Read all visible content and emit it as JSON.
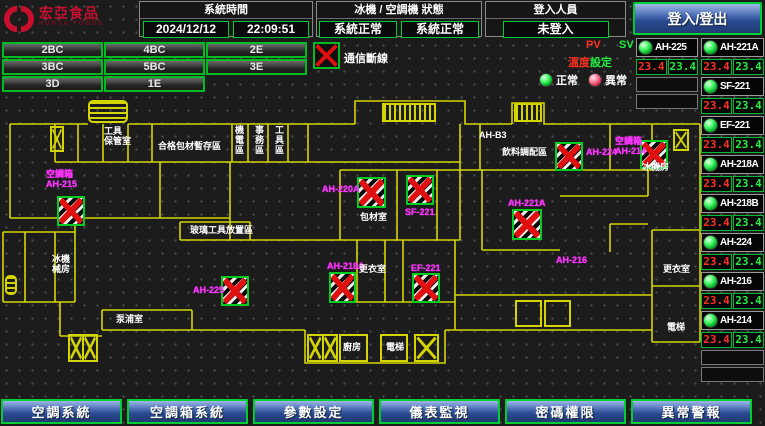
{
  "header": {
    "logo": {
      "brand": "宏亞食品",
      "brand_en": "HUNYA FOODS"
    },
    "system_time": {
      "title": "系統時間",
      "date": "2024/12/12",
      "time": "22:09:51"
    },
    "machine_status": {
      "title": "冰機 / 空調機 狀態",
      "chiller": "系統正常",
      "ac": "系統正常"
    },
    "login": {
      "title": "登入人員",
      "value": "未登入"
    },
    "login_button": "登入/登出"
  },
  "zones": [
    "2BC",
    "4BC",
    "2E",
    "3BC",
    "5BC",
    "3E",
    "3D",
    "1E"
  ],
  "legend": {
    "comm_fail": "通信斷線",
    "pv": "PV",
    "sv": "SV",
    "pv_label": "溫度",
    "sv_label": "設定",
    "normal": "正常",
    "abnormal": "異常"
  },
  "monitors": {
    "left_column": [
      {
        "name": "AH-225",
        "pv": "23.4",
        "sv": "23.4"
      }
    ],
    "left_empty_rows": 2,
    "right_column": [
      {
        "name": "AH-221A",
        "pv": "23.4",
        "sv": "23.4"
      },
      {
        "name": "SF-221",
        "pv": "23.4",
        "sv": "23.4"
      },
      {
        "name": "EF-221",
        "pv": "23.4",
        "sv": "23.4"
      },
      {
        "name": "AH-218A",
        "pv": "23.4",
        "sv": "23.4"
      },
      {
        "name": "AH-218B",
        "pv": "23.4",
        "sv": "23.4"
      },
      {
        "name": "AH-224",
        "pv": "23.4",
        "sv": "23.4"
      },
      {
        "name": "AH-216",
        "pv": "23.4",
        "sv": "23.4"
      },
      {
        "name": "AH-214",
        "pv": "23.4",
        "sv": "23.4"
      }
    ],
    "right_empty_rows": 2
  },
  "plan": {
    "units": [
      {
        "label": "空調箱\nAH-215",
        "lx": 46,
        "ly": 169,
        "x": 57,
        "y": 196,
        "w": 28,
        "h": 30
      },
      {
        "label": "AH-225",
        "lx": 193,
        "ly": 285,
        "x": 221,
        "y": 276,
        "w": 28,
        "h": 30
      },
      {
        "label": "AH-220A",
        "lx": 322,
        "ly": 184,
        "x": 357,
        "y": 177,
        "w": 29,
        "h": 31
      },
      {
        "label": "SF-221",
        "lx": 405,
        "ly": 207,
        "x": 406,
        "y": 175,
        "w": 28,
        "h": 30
      },
      {
        "label": "AH-218A",
        "lx": 327,
        "ly": 261,
        "x": 329,
        "y": 272,
        "w": 27,
        "h": 31
      },
      {
        "label": "EF-221",
        "lx": 411,
        "ly": 263,
        "x": 412,
        "y": 273,
        "w": 28,
        "h": 30
      },
      {
        "label": "AH-221A",
        "lx": 508,
        "ly": 198,
        "x": 512,
        "y": 209,
        "w": 30,
        "h": 31
      },
      {
        "label": "AH-224",
        "lx": 586,
        "ly": 147,
        "x": 555,
        "y": 142,
        "w": 28,
        "h": 29
      },
      {
        "label": "空調箱\nAH-214",
        "lx": 615,
        "ly": 136,
        "x": 640,
        "y": 140,
        "w": 28,
        "h": 29
      }
    ],
    "extra_labels": [
      {
        "text": "AH-216",
        "x": 556,
        "y": 255
      }
    ],
    "rooms": [
      {
        "text": "工具\n保管室",
        "x": 104,
        "y": 126
      },
      {
        "text": "合格包材暫存區",
        "x": 158,
        "y": 141
      },
      {
        "text": "機\n電\n區",
        "x": 235,
        "y": 125
      },
      {
        "text": "事\n務\n區",
        "x": 255,
        "y": 125
      },
      {
        "text": "工\n具\n區",
        "x": 275,
        "y": 125
      },
      {
        "text": "玻璃工具放置區",
        "x": 190,
        "y": 225
      },
      {
        "text": "冰機\n械房",
        "x": 52,
        "y": 254
      },
      {
        "text": "泵浦室",
        "x": 116,
        "y": 314
      },
      {
        "text": "包材室",
        "x": 360,
        "y": 212
      },
      {
        "text": "更衣室",
        "x": 359,
        "y": 264
      },
      {
        "text": "AH-B3",
        "x": 479,
        "y": 130
      },
      {
        "text": "飲料調配區",
        "x": 502,
        "y": 147
      },
      {
        "text": "冰機房",
        "x": 642,
        "y": 162
      },
      {
        "text": "更衣室",
        "x": 663,
        "y": 264
      },
      {
        "text": "電梯",
        "x": 667,
        "y": 322
      },
      {
        "text": "廚房",
        "x": 343,
        "y": 342
      },
      {
        "text": "電梯",
        "x": 386,
        "y": 342
      }
    ],
    "stairs": [
      {
        "kind": "stripes",
        "x": 88,
        "y": 100,
        "w": 40,
        "h": 23
      },
      {
        "kind": "stripes-v",
        "x": 382,
        "y": 103,
        "w": 54,
        "h": 19
      },
      {
        "kind": "stripes-v",
        "x": 514,
        "y": 103,
        "w": 28,
        "h": 19
      },
      {
        "kind": "x",
        "x": 50,
        "y": 126,
        "w": 14,
        "h": 26
      },
      {
        "kind": "stripes",
        "x": 5,
        "y": 275,
        "w": 12,
        "h": 20
      },
      {
        "kind": "xx",
        "x": 68,
        "y": 334,
        "w": 30,
        "h": 28
      },
      {
        "kind": "xx",
        "x": 307,
        "y": 334,
        "w": 31,
        "h": 28
      },
      {
        "kind": "box",
        "x": 339,
        "y": 334,
        "w": 29,
        "h": 28
      },
      {
        "kind": "box",
        "x": 380,
        "y": 334,
        "w": 28,
        "h": 28
      },
      {
        "kind": "x",
        "x": 414,
        "y": 334,
        "w": 25,
        "h": 28
      },
      {
        "kind": "x",
        "x": 673,
        "y": 129,
        "w": 16,
        "h": 22
      },
      {
        "kind": "box",
        "x": 515,
        "y": 300,
        "w": 27,
        "h": 27
      },
      {
        "kind": "box",
        "x": 544,
        "y": 300,
        "w": 27,
        "h": 27
      }
    ]
  },
  "nav": [
    "空調系統",
    "空調箱系統",
    "參數設定",
    "儀表監視",
    "密碼權限",
    "異常警報"
  ],
  "colors": {
    "accent_green": "#00cc33",
    "alarm_red": "#e01010",
    "magenta": "#ff35ff",
    "wall_yellow": "#d4d400",
    "button_blue": "#2a4a8e",
    "brand_red": "#c8102e"
  }
}
